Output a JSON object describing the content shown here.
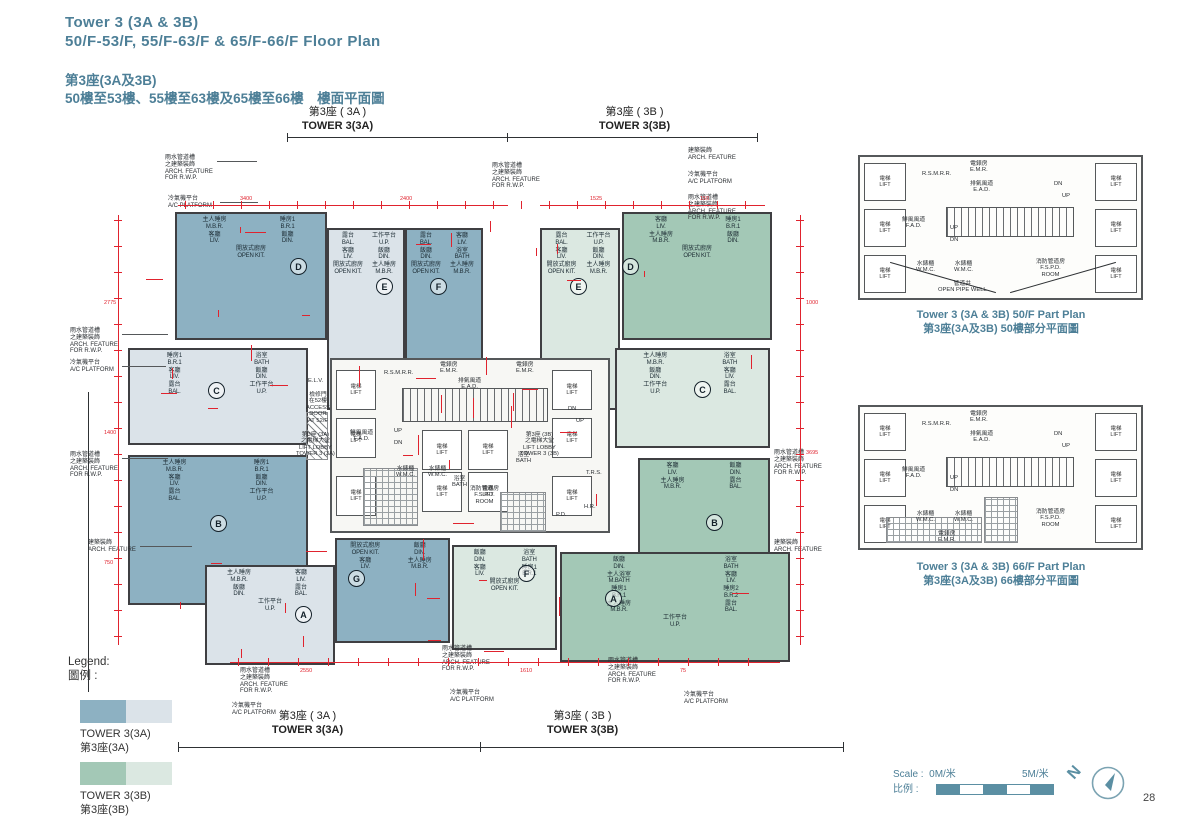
{
  "page": {
    "number": "28"
  },
  "colors": {
    "accent": "#4d7f97",
    "dim_red": "#e0232e",
    "tower_a_dark": "#8db1c2",
    "tower_a_light": "#dbe3e9",
    "tower_b_dark": "#a3c8b6",
    "tower_b_light": "#dbe8e1",
    "wall": "#3f3f42",
    "scale_teal": "#5b8fa3"
  },
  "header": {
    "title_en_1": "Tower 3 (3A & 3B)",
    "title_en_2": "50/F-53/F, 55/F-63/F & 65/F-66/F   Floor Plan",
    "title_zh_1": "第3座(3A及3B)",
    "title_zh_2": "50樓至53樓、55樓至63樓及65樓至66樓　樓面平面圖"
  },
  "plan": {
    "tower_a_label": {
      "zh": "第3座 ( 3A )",
      "en": "TOWER 3(3A)"
    },
    "tower_b_label": {
      "zh": "第3座 ( 3B )",
      "en": "TOWER 3(3B)"
    },
    "units": [
      {
        "letter": "D",
        "tower": "3A",
        "rooms": [
          {
            "zh": "主人睡房",
            "en": "M.B.R."
          },
          {
            "zh": "睡房1",
            "en": "B.R.1"
          },
          {
            "zh": "客廳",
            "en": "LIV."
          },
          {
            "zh": "飯廳",
            "en": "DIN."
          },
          {
            "zh": "開放式廚房",
            "en": "OPEN KIT."
          }
        ]
      },
      {
        "letter": "E",
        "tower": "3A",
        "rooms": [
          {
            "zh": "露台",
            "en": "BAL."
          },
          {
            "zh": "工作平台",
            "en": "U.P."
          },
          {
            "zh": "客廳",
            "en": "LIV."
          },
          {
            "zh": "飯廳",
            "en": "DIN."
          },
          {
            "zh": "開放式廚房",
            "en": "OPEN KIT."
          },
          {
            "zh": "主人睡房",
            "en": "M.B.R."
          }
        ]
      },
      {
        "letter": "F",
        "tower": "3A",
        "rooms": [
          {
            "zh": "露台",
            "en": "BAL."
          },
          {
            "zh": "客廳",
            "en": "LIV."
          },
          {
            "zh": "飯廳",
            "en": "DIN."
          },
          {
            "zh": "浴室",
            "en": "BATH"
          },
          {
            "zh": "開放式廚房",
            "en": "OPEN KIT."
          },
          {
            "zh": "主人睡房",
            "en": "M.B.R."
          }
        ]
      },
      {
        "letter": "C",
        "tower": "3A",
        "rooms": [
          {
            "zh": "睡房1",
            "en": "B.R.1"
          },
          {
            "zh": "浴室",
            "en": "BATH"
          },
          {
            "zh": "客廳",
            "en": "LIV."
          },
          {
            "zh": "飯廳",
            "en": "DIN."
          },
          {
            "zh": "露台",
            "en": "BAL."
          },
          {
            "zh": "工作平台",
            "en": "U.P."
          }
        ]
      },
      {
        "letter": "B",
        "tower": "3A",
        "rooms": [
          {
            "zh": "主人睡房",
            "en": "M.B.R."
          },
          {
            "zh": "睡房1",
            "en": "B.R.1"
          },
          {
            "zh": "客廳",
            "en": "LIV."
          },
          {
            "zh": "飯廳",
            "en": "DIN."
          },
          {
            "zh": "露台",
            "en": "BAL."
          },
          {
            "zh": "工作平台",
            "en": "U.P."
          }
        ]
      },
      {
        "letter": "A",
        "tower": "3A",
        "rooms": [
          {
            "zh": "主人睡房",
            "en": "M.B.R."
          },
          {
            "zh": "客廳",
            "en": "LIV."
          },
          {
            "zh": "飯廳",
            "en": "DIN."
          },
          {
            "zh": "露台",
            "en": "BAL."
          },
          {
            "zh": "工作平台",
            "en": "U.P."
          }
        ]
      },
      {
        "letter": "G",
        "tower": "3A",
        "rooms": [
          {
            "zh": "開放式廚房",
            "en": "OPEN KIT."
          },
          {
            "zh": "飯廳",
            "en": "DIN."
          },
          {
            "zh": "客廳",
            "en": "LIV."
          },
          {
            "zh": "主人睡房",
            "en": "M.B.R."
          }
        ]
      },
      {
        "letter": "E",
        "tower": "3B",
        "rooms": [
          {
            "zh": "露台",
            "en": "BAL."
          },
          {
            "zh": "工作平台",
            "en": "U.P."
          },
          {
            "zh": "客廳",
            "en": "LIV."
          },
          {
            "zh": "飯廳",
            "en": "DIN."
          },
          {
            "zh": "開放式廚房",
            "en": "OPEN KIT."
          },
          {
            "zh": "主人睡房",
            "en": "M.B.R."
          }
        ]
      },
      {
        "letter": "D",
        "tower": "3B",
        "rooms": [
          {
            "zh": "客廳",
            "en": "LIV."
          },
          {
            "zh": "睡房1",
            "en": "B.R.1"
          },
          {
            "zh": "主人睡房",
            "en": "M.B.R."
          },
          {
            "zh": "飯廳",
            "en": "DIN."
          },
          {
            "zh": "開放式廚房",
            "en": "OPEN KIT."
          }
        ]
      },
      {
        "letter": "C",
        "tower": "3B",
        "rooms": [
          {
            "zh": "主人睡房",
            "en": "M.B.R."
          },
          {
            "zh": "浴室",
            "en": "BATH"
          },
          {
            "zh": "飯廳",
            "en": "DIN."
          },
          {
            "zh": "客廳",
            "en": "LIV."
          },
          {
            "zh": "工作平台",
            "en": "U.P."
          },
          {
            "zh": "露台",
            "en": "BAL."
          }
        ]
      },
      {
        "letter": "B",
        "tower": "3B",
        "rooms": [
          {
            "zh": "客廳",
            "en": "LIV."
          },
          {
            "zh": "飯廳",
            "en": "DIN."
          },
          {
            "zh": "主人睡房",
            "en": "M.B.R."
          },
          {
            "zh": "露台",
            "en": "BAL."
          }
        ]
      },
      {
        "letter": "F",
        "tower": "3B",
        "rooms": [
          {
            "zh": "飯廳",
            "en": "DIN."
          },
          {
            "zh": "浴室",
            "en": "BATH"
          },
          {
            "zh": "客廳",
            "en": "LIV."
          },
          {
            "zh": "睡房1",
            "en": "B.R.1"
          },
          {
            "zh": "開放式廚房",
            "en": "OPEN KIT."
          }
        ]
      },
      {
        "letter": "A",
        "tower": "3B",
        "rooms": [
          {
            "zh": "飯廳",
            "en": "DIN."
          },
          {
            "zh": "浴室",
            "en": "BATH"
          },
          {
            "zh": "主人浴室",
            "en": "M.BATH"
          },
          {
            "zh": "客廳",
            "en": "LIV."
          },
          {
            "zh": "睡房1",
            "en": "B.R.1"
          },
          {
            "zh": "睡房2",
            "en": "B.R.2"
          },
          {
            "zh": "主人睡房",
            "en": "M.B.R."
          },
          {
            "zh": "露台",
            "en": "BAL."
          },
          {
            "zh": "工作平台",
            "en": "U.P."
          }
        ]
      }
    ],
    "lift": {
      "zh": "電梯",
      "en": "LIFT"
    },
    "core_labels": [
      {
        "lines": [
          "R.S.M.R.R."
        ]
      },
      {
        "lines": [
          "電錶房",
          "E.M.R."
        ]
      },
      {
        "lines": [
          "電錶房",
          "E.M.R."
        ]
      },
      {
        "lines": [
          "排氣風道",
          "E.A.D."
        ]
      },
      {
        "lines": [
          "鮮風風道",
          "F.A.D."
        ]
      },
      {
        "lines": [
          "UP"
        ]
      },
      {
        "lines": [
          "DN"
        ]
      },
      {
        "lines": [
          "DN"
        ]
      },
      {
        "lines": [
          "UP"
        ]
      },
      {
        "lines": [
          "水錶櫃",
          "W.M.C."
        ]
      },
      {
        "lines": [
          "水錶櫃",
          "W.M.C."
        ]
      },
      {
        "lines": [
          "消防管道房",
          "F.S.P.D.",
          "ROOM"
        ]
      },
      {
        "lines": [
          "E.L.V."
        ]
      },
      {
        "lines": [
          "檢修門",
          "在52樓",
          "ACCESS",
          "DOOR",
          "AT 52/F"
        ]
      },
      {
        "lines": [
          "第3座 (3A)",
          "之電梯大堂",
          "LIFT LOBBY",
          "TOWER 3 (3A)"
        ]
      },
      {
        "lines": [
          "第3座 (3B)",
          "之電梯大堂",
          "LIFT LOBBY",
          "TOWER 3 (3B)"
        ]
      },
      {
        "lines": [
          "T.R.S."
        ]
      },
      {
        "lines": [
          "H.R."
        ]
      },
      {
        "lines": [
          "P.D."
        ]
      },
      {
        "lines": [
          "浴室",
          "BATH"
        ]
      },
      {
        "lines": [
          "浴室",
          "BATH"
        ]
      }
    ],
    "annotation_types": [
      {
        "lines": [
          "雨水管道槽",
          "之建築裝飾",
          "ARCH. FEATURE",
          "FOR R.W.P."
        ]
      },
      {
        "lines": [
          "冷氣機平台",
          "A/C PLATFORM"
        ]
      },
      {
        "lines": [
          "建築裝飾",
          "ARCH. FEATURE"
        ]
      }
    ],
    "sample_dimensions": [
      "3400",
      "2400",
      "1525",
      "150",
      "2775",
      "1400",
      "750",
      "1000",
      "3695",
      "2550",
      "1610",
      "75"
    ]
  },
  "part_plans": [
    {
      "caption_en": "Tower 3 (3A & 3B) 50/F Part Plan",
      "caption_zh": "第3座(3A及3B) 50樓部分平面圖",
      "labels": [
        {
          "lines": [
            "R.S.M.R.R."
          ]
        },
        {
          "lines": [
            "電錶房",
            "E.M.R."
          ]
        },
        {
          "lines": [
            "排氣風道",
            "E.A.D."
          ]
        },
        {
          "lines": [
            "鮮風風道",
            "F.A.D."
          ]
        },
        {
          "lines": [
            "UP"
          ]
        },
        {
          "lines": [
            "DN"
          ]
        },
        {
          "lines": [
            "DN"
          ]
        },
        {
          "lines": [
            "UP"
          ]
        },
        {
          "lines": [
            "水錶櫃",
            "W.M.C."
          ]
        },
        {
          "lines": [
            "水錶櫃",
            "W.M.C."
          ]
        },
        {
          "lines": [
            "消防管道房",
            "F.S.P.D.",
            "ROOM"
          ]
        },
        {
          "lines": [
            "管道井",
            "OPEN PIPE WELL"
          ]
        }
      ]
    },
    {
      "caption_en": "Tower 3 (3A & 3B) 66/F Part Plan",
      "caption_zh": "第3座(3A及3B) 66樓部分平面圖",
      "labels": [
        {
          "lines": [
            "R.S.M.R.R."
          ]
        },
        {
          "lines": [
            "電錶房",
            "E.M.R."
          ]
        },
        {
          "lines": [
            "排氣風道",
            "E.A.D."
          ]
        },
        {
          "lines": [
            "鮮風風道",
            "F.A.D."
          ]
        },
        {
          "lines": [
            "UP"
          ]
        },
        {
          "lines": [
            "DN"
          ]
        },
        {
          "lines": [
            "DN"
          ]
        },
        {
          "lines": [
            "UP"
          ]
        },
        {
          "lines": [
            "水錶櫃",
            "W.M.C."
          ]
        },
        {
          "lines": [
            "水錶櫃",
            "W.M.C."
          ]
        },
        {
          "lines": [
            "消防管道房",
            "F.S.P.D.",
            "ROOM"
          ]
        },
        {
          "lines": [
            "電錶房",
            "E.M.R."
          ]
        }
      ]
    }
  ],
  "legend": {
    "title_en": "Legend:",
    "title_zh": "圖例 :",
    "items": [
      {
        "label_en": "TOWER 3(3A)",
        "label_zh": "第3座(3A)",
        "dark": "#8db1c2",
        "light": "#dbe3e9"
      },
      {
        "label_en": "TOWER 3(3B)",
        "label_zh": "第3座(3B)",
        "dark": "#a3c8b6",
        "light": "#dbe8e1"
      }
    ]
  },
  "scale_bar": {
    "label_en": "Scale :",
    "label_zh": "比例 :",
    "start": "0M/米",
    "end": "5M/米",
    "segments": 5
  },
  "compass": {
    "letter": "N"
  }
}
